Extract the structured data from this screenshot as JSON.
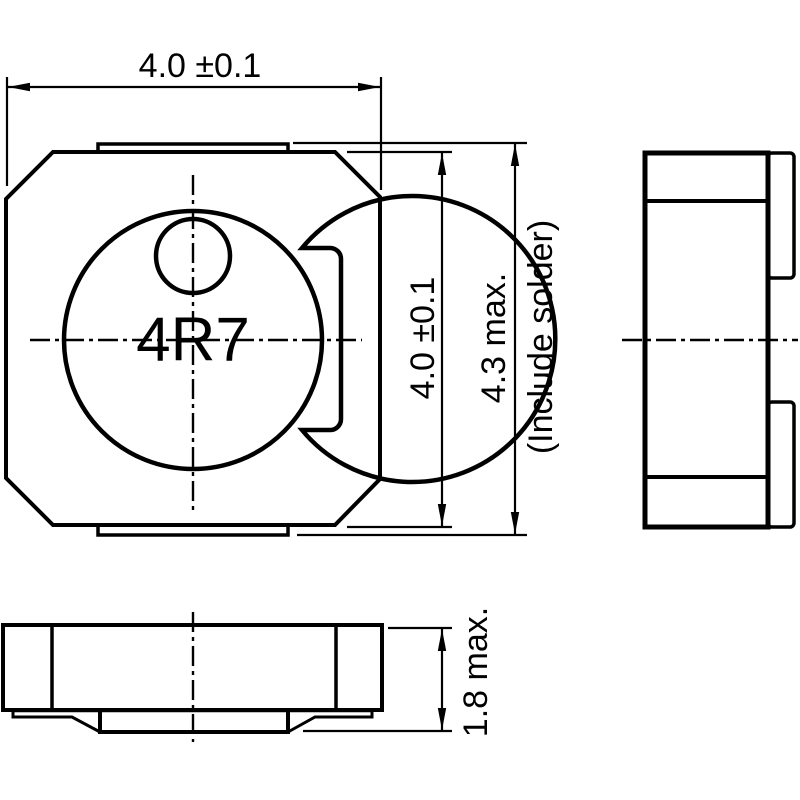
{
  "colors": {
    "ink": "#000000",
    "background": "#ffffff"
  },
  "labels": {
    "marking": "4R7",
    "dim_width": "4.0 ±0.1",
    "dim_height": "4.0 ±0.1",
    "dim_overall_height": "4.3 max.",
    "dim_overall_height_note": "(Include solder)",
    "dim_thickness": "1.8 max."
  }
}
